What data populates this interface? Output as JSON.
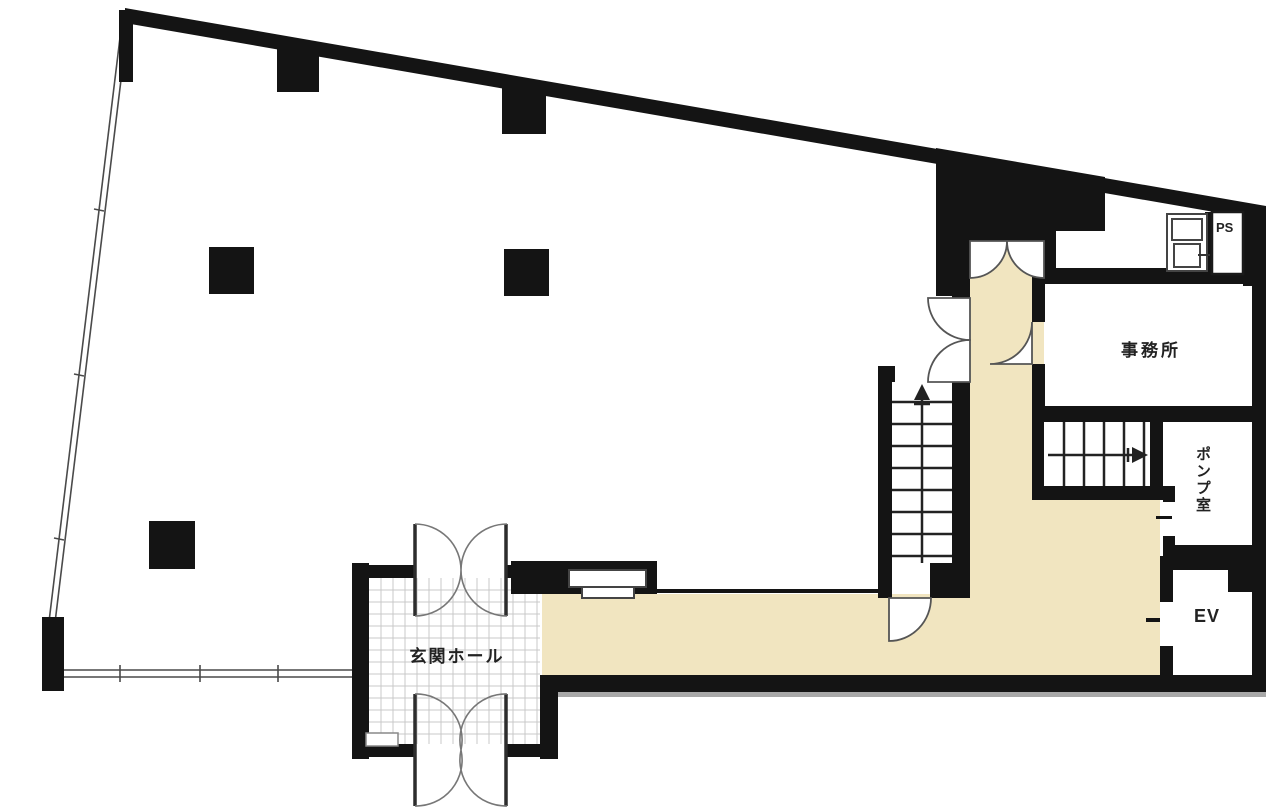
{
  "plan_type": "floor-plan",
  "rooms": {
    "office": {
      "label": "事務所"
    },
    "pump_room": {
      "label": "ポンプ室"
    },
    "elevator": {
      "label": "EV"
    },
    "pipe_shaft": {
      "label": "PS"
    },
    "entrance_hall": {
      "label": "玄関ホール"
    }
  },
  "symbols": {
    "main_staircase_direction": "up",
    "upper_staircase_direction": "right",
    "columns_count": 5,
    "entrance_double_doors": 2
  },
  "colors": {
    "wall": "#141414",
    "corridor_floor": "#F1E5C0",
    "tile_line": "#C9C9C9",
    "window_line": "#4a4a4a",
    "shadow": "#A8A8A8",
    "background": "#FFFFFF"
  }
}
